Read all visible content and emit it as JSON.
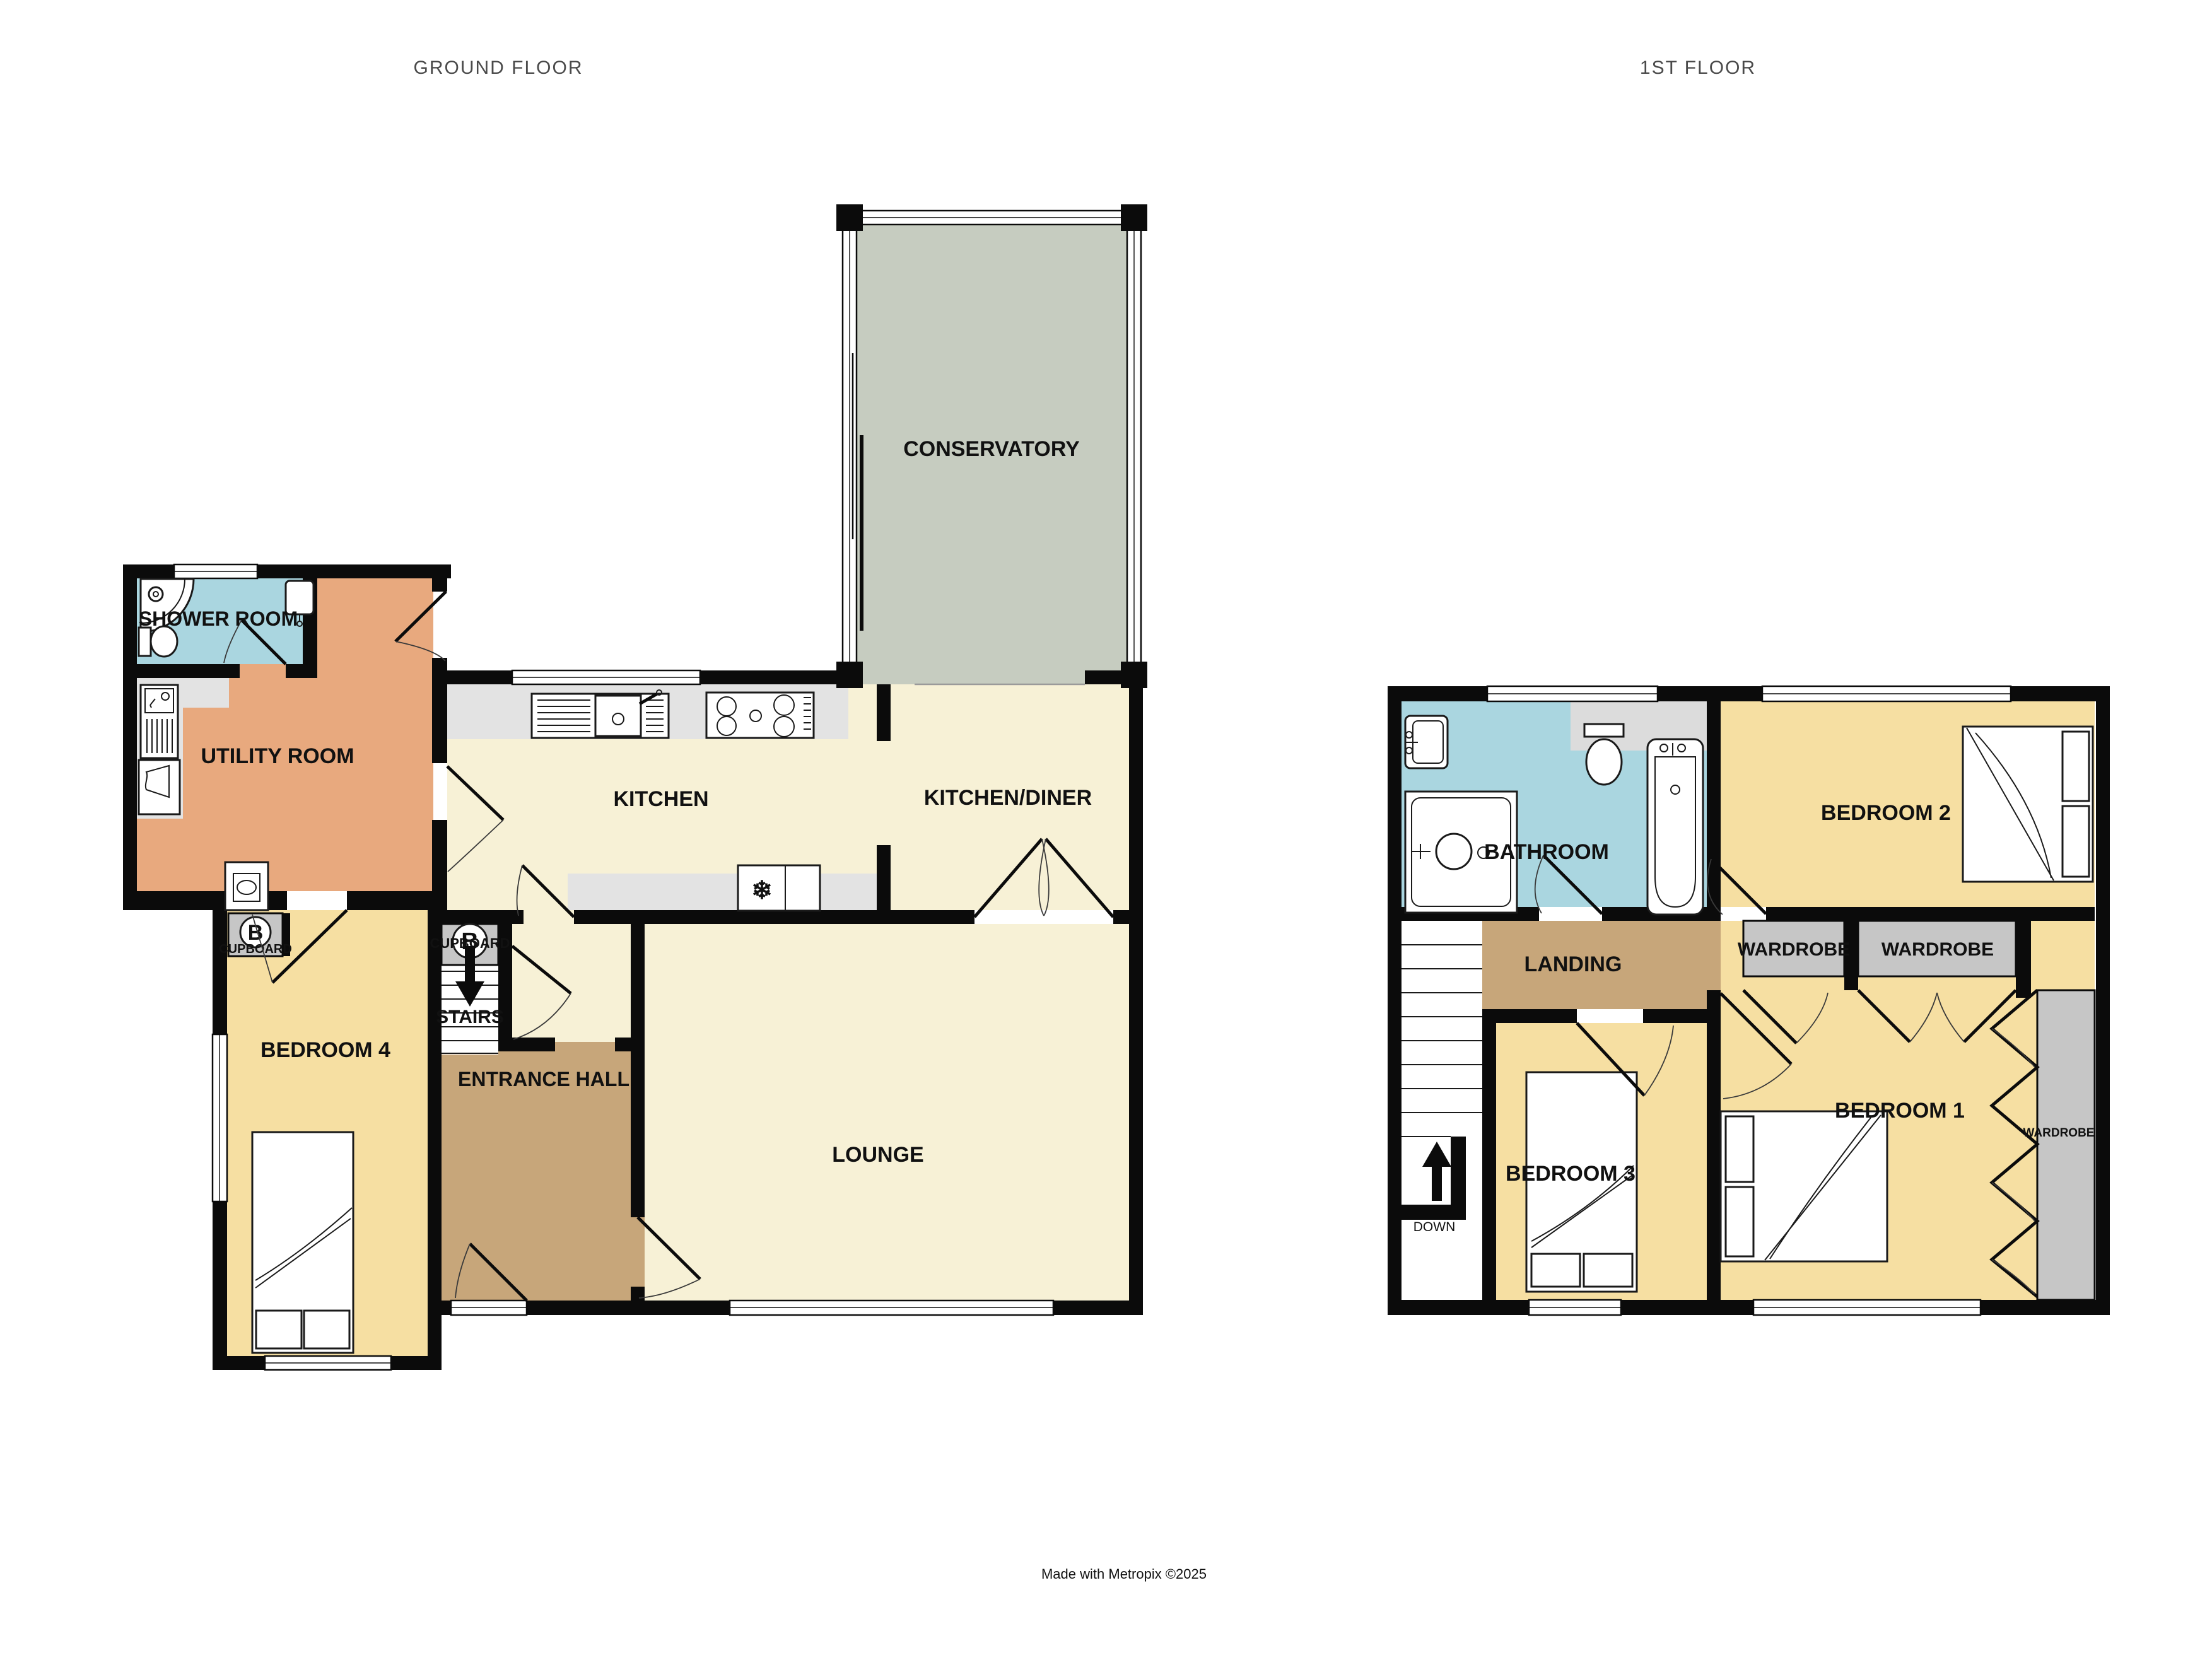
{
  "titles": {
    "ground": "GROUND FLOOR",
    "first": "1ST FLOOR"
  },
  "credit": "Made with Metropix ©2025",
  "colors": {
    "wall": "#0b0b0b",
    "cream_room": "#f7f1d6",
    "yellow_bedroom": "#f6dfa2",
    "orange_utility": "#e8a97e",
    "blue_bathroom": "#aad6e0",
    "brown_hall": "#c7a67a",
    "gray_storage": "#c6c6c6",
    "counter_gray": "#e3e3e3",
    "conservatory_green": "#c6ccc0",
    "title_text": "#4a4a4a"
  },
  "ground_floor": {
    "conservatory": "CONSERVATORY",
    "kitchen": "KITCHEN",
    "kitchen_diner": "KITCHEN/DINER",
    "lounge": "LOUNGE",
    "shower_room": "SHOWER ROOM",
    "utility_room": "UTILITY ROOM",
    "bedroom4": "BEDROOM 4",
    "entrance_hall": "ENTRANCE HALL",
    "stairs": "STAIRS",
    "cupboard_a": "CUPBOARD",
    "cupboard_b": "CUPBOARD",
    "boiler": "B",
    "fridge_glyph": "❄"
  },
  "first_floor": {
    "bathroom": "BATHROOM",
    "bedroom1": "BEDROOM 1",
    "bedroom2": "BEDROOM 2",
    "bedroom3": "BEDROOM 3",
    "landing": "LANDING",
    "wardrobe_left": "WARDROBE",
    "wardrobe_right": "WARDROBE",
    "wardrobe_side": "WARDROBE",
    "down": "DOWN"
  },
  "icons": [
    "corner-shower-icon",
    "toilet-icon",
    "sink-icon",
    "bath-icon",
    "shower-tray-icon",
    "kitchen-sink-icon",
    "hob-icon",
    "fridge-icon",
    "washing-machine-icon",
    "dryer-icon",
    "boiler-icon",
    "bed-icon",
    "stairs-icon",
    "arrow-down-icon",
    "arrow-up-icon"
  ]
}
